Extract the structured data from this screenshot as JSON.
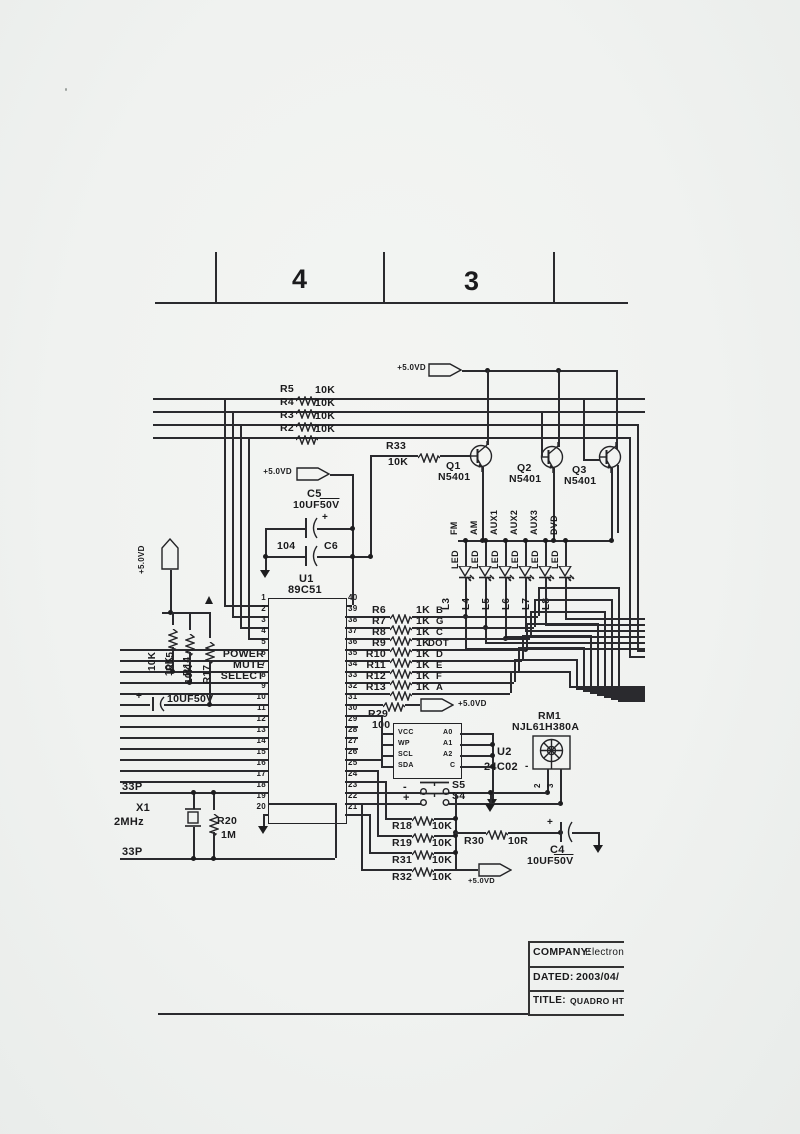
{
  "sheet": {
    "zones": [
      "4",
      "3"
    ],
    "title_block": {
      "company_label": "COMPANY:",
      "company_value": "Electron",
      "dated_label": "DATED:",
      "dated_value": "2003/04/",
      "title_label": "TITLE:",
      "title_value": "QUADRO HT-5"
    }
  },
  "power": {
    "vcc": "+5.0VD"
  },
  "u1": {
    "ref": "U1",
    "part": "89C51",
    "pin_names": {
      "p6": "POWER",
      "p7": "MUTE",
      "p8": "SELECT"
    },
    "left_pins": [
      1,
      2,
      3,
      4,
      5,
      6,
      7,
      8,
      9,
      10,
      11,
      12,
      13,
      14,
      15,
      16,
      17,
      18,
      19,
      20
    ],
    "right_pins": [
      40,
      39,
      38,
      37,
      36,
      35,
      34,
      33,
      32,
      31,
      30,
      29,
      28,
      27,
      26,
      25,
      24,
      23,
      22,
      21
    ]
  },
  "u2": {
    "ref": "U2",
    "part": "24C02",
    "left_pins": [
      "VCC",
      "WP",
      "SCL",
      "SDA"
    ],
    "right_pins": [
      "A0",
      "A1",
      "A2",
      "C"
    ]
  },
  "rm1": {
    "ref": "RM1",
    "part": "NJL61H380A",
    "pin2": "2",
    "pin3": "3",
    "minus": "-"
  },
  "transistors": [
    {
      "ref": "Q1",
      "part": "N5401"
    },
    {
      "ref": "Q2",
      "part": "N5401"
    },
    {
      "ref": "Q3",
      "part": "N5401"
    }
  ],
  "top_resistors": [
    {
      "ref": "R5",
      "value": "10K"
    },
    {
      "ref": "R4",
      "value": "10K"
    },
    {
      "ref": "R3",
      "value": "10K"
    },
    {
      "ref": "R2",
      "value": "10K"
    }
  ],
  "r33": {
    "ref": "R33",
    "value": "10K"
  },
  "seg_resistors": [
    {
      "ref": "R6",
      "value": "1K",
      "net": "B"
    },
    {
      "ref": "R7",
      "value": "1K",
      "net": "G"
    },
    {
      "ref": "R8",
      "value": "1K",
      "net": "C"
    },
    {
      "ref": "R9",
      "value": "1K",
      "net": "DOT"
    },
    {
      "ref": "R10",
      "value": "1K",
      "net": "D"
    },
    {
      "ref": "R11",
      "value": "1K",
      "net": "E"
    },
    {
      "ref": "R12",
      "value": "1K",
      "net": "F"
    },
    {
      "ref": "R13",
      "value": "1K",
      "net": "A"
    }
  ],
  "leds": [
    {
      "ref": "L3",
      "symbol": "LED",
      "func": "FM"
    },
    {
      "ref": "L4",
      "symbol": "LED",
      "func": "AM"
    },
    {
      "ref": "L5",
      "symbol": "LED",
      "func": "AUX1"
    },
    {
      "ref": "L6",
      "symbol": "LED",
      "func": "AUX2"
    },
    {
      "ref": "L7",
      "symbol": "LED",
      "func": "AUX3"
    },
    {
      "ref": "L8",
      "symbol": "LED",
      "func": "DVD"
    }
  ],
  "pullups": [
    {
      "ref": "R15",
      "value": "10K"
    },
    {
      "ref": "R14",
      "value": "10K"
    },
    {
      "ref": "R17",
      "value": "10K"
    }
  ],
  "r29": {
    "ref": "R29",
    "value": "100"
  },
  "r30": {
    "ref": "R30",
    "value": "10R"
  },
  "bottom_resistors": [
    {
      "ref": "R18",
      "value": "10K"
    },
    {
      "ref": "R19",
      "value": "10K"
    },
    {
      "ref": "R31",
      "value": "10K"
    },
    {
      "ref": "R32",
      "value": "10K"
    }
  ],
  "switches": [
    {
      "ref": "S5",
      "sign": "-"
    },
    {
      "ref": "S4",
      "sign": "+"
    }
  ],
  "caps": {
    "c5": {
      "ref": "C5",
      "value": "10UF",
      "volt": "50V",
      "plus": "+"
    },
    "c6": {
      "ref": "C6",
      "value": "104"
    },
    "c4": {
      "ref": "C4",
      "value": "10UF",
      "volt": "50V",
      "plus": "+"
    },
    "cin": {
      "value": "10UF50V",
      "plus": "+"
    }
  },
  "xtal": {
    "ref": "X1",
    "freq": "2MHz",
    "ctop": "33P",
    "cbot": "33P"
  },
  "r20": {
    "ref": "R20",
    "value": "1M"
  }
}
